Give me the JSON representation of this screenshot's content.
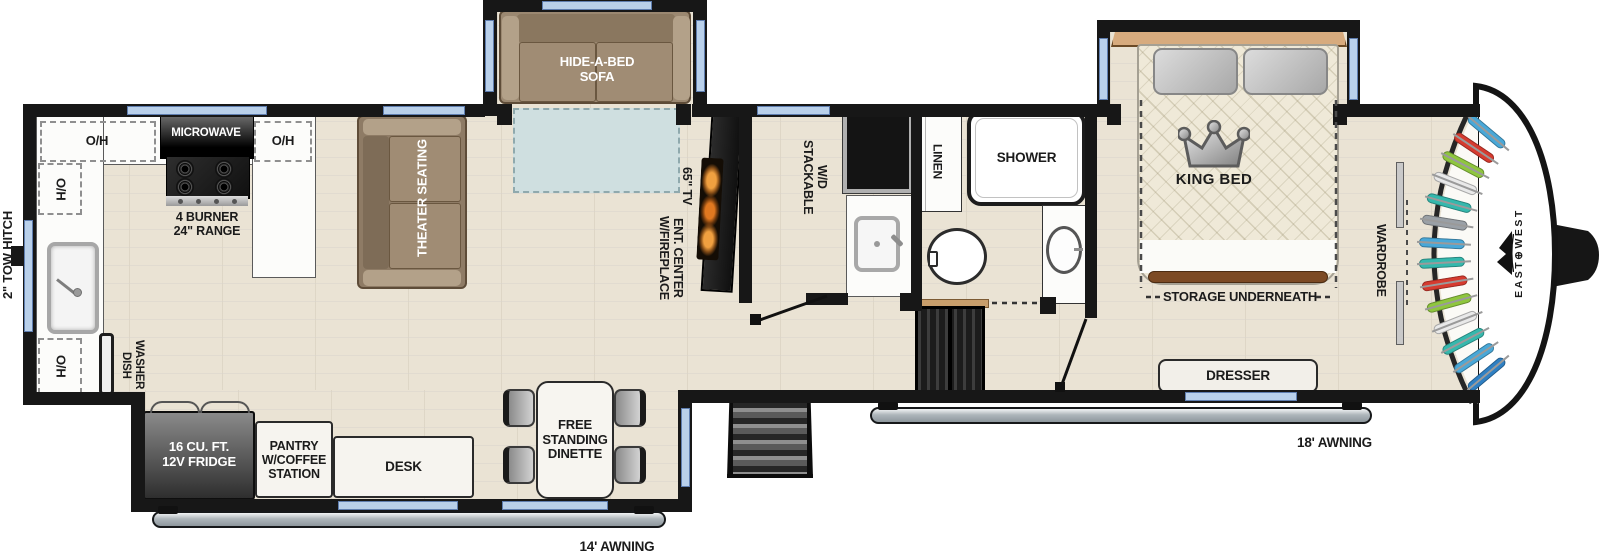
{
  "plan": {
    "brand": "EAST⊕WEST",
    "hitch_label": "2\" TOW HITCH",
    "awning_front": "18' AWNING",
    "awning_rear": "14' AWNING"
  },
  "kitchen": {
    "oh": "O/H",
    "microwave": "MICROWAVE",
    "range": "4 BURNER\n24\" RANGE",
    "dishwasher": "DISH\nWASHER",
    "fridge": "16 CU. FT.\n12V FRIDGE",
    "pantry": "PANTRY\nW/COFFEE\nSTATION"
  },
  "living": {
    "sofa": "HIDE-A-BED\nSOFA",
    "theater": "THEATER SEATING",
    "tv": "65\" TV",
    "ent_center": "ENT. CENTER\nW/FIREPLACE",
    "dinette": "FREE\nSTANDING\nDINETTE",
    "desk": "DESK"
  },
  "bath": {
    "washer_dryer": "STACKABLE\nW/D",
    "linen": "LINEN",
    "shower": "SHOWER"
  },
  "bedroom": {
    "bed": "KING BED",
    "storage": "STORAGE UNDERNEATH",
    "wardrobe": "WARDROBE",
    "dresser": "DRESSER"
  },
  "closet": {
    "clothes_colors": [
      "#49a8d8",
      "#d63b2f",
      "#8fc63e",
      "#e9e9e9",
      "#35b8ad",
      "#9aa0a6",
      "#49a8d8",
      "#35b8ad",
      "#d63b2f",
      "#8fc63e",
      "#e9e9e9",
      "#35b8ad",
      "#49a8d8",
      "#2f80c3"
    ]
  },
  "palette": {
    "wall": "#171717",
    "floor": "#eae3d4",
    "rug": "#cfdfe0",
    "window": "#b9d0ea",
    "sofa_brown": "#9b8871",
    "accent_flame": "#f08a28"
  }
}
